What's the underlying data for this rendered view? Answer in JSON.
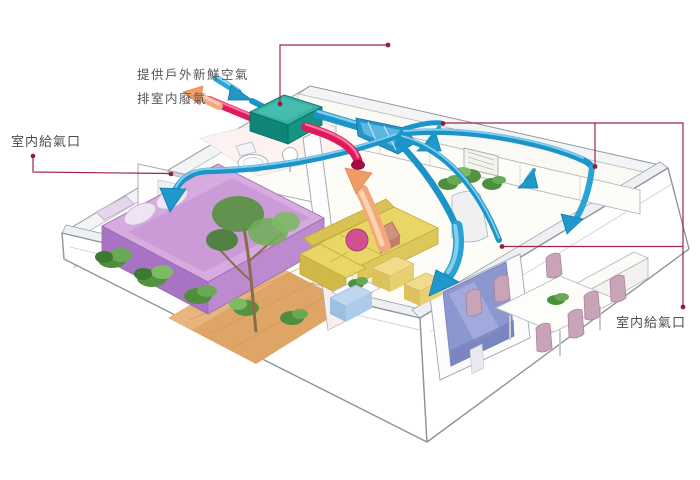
{
  "diagram": {
    "type": "home-ventilation-isometric-cutaway",
    "labels": {
      "fresh_air_supply": "提供戶外新鮮空氣",
      "indoor_exhaust": "排室内廢氣",
      "indoor_supply_vent_left": "室内給氣口",
      "indoor_supply_vent_right": "室内給氣口"
    },
    "colors": {
      "supply_duct_blue": "#1b94ca",
      "exhaust_duct_red": "#e0195d",
      "hrv_unit_teal": "#2fae9f",
      "exhaust_air_orange": "#f3a87c",
      "leader_line_maroon": "#a22446",
      "label_text": "#565656"
    },
    "icons": {
      "fresh_air_in": "blue-arrow-into-unit",
      "exhaust_air_out": "orange-arrow-out-of-unit",
      "room_supply": "blue-curved-arrows-into-rooms",
      "return_air": "orange-arrow-up-into-exhaust-duct"
    },
    "components": [
      "heat-recovery-ventilator-unit",
      "supply-duct-branches",
      "exhaust-duct",
      "house-cutaway-bedroom-bathroom-living-dining-kitchen-media-room"
    ]
  }
}
